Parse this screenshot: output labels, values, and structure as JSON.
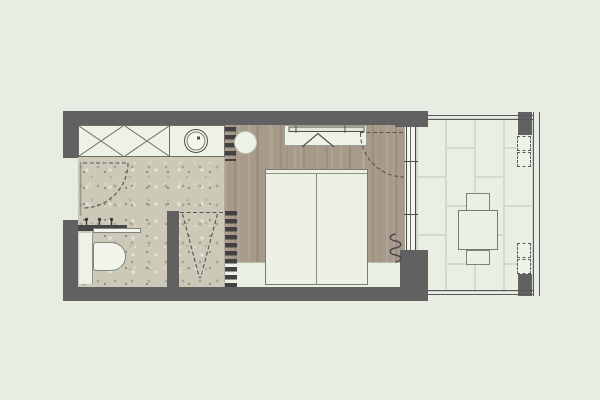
{
  "plan": {
    "kind": "studio-apartment-floor-plan",
    "rooms": [
      {
        "name": "bathroom",
        "fixtures": [
          "double-wardrobe-with-x-symbols",
          "counter-with-round-basin",
          "entry-door-swing",
          "towel-rail-with-hooks",
          "floating-shelf",
          "wall-hung-toilet",
          "walk-in-shower-with-drain-slope",
          "slatted-screen"
        ]
      },
      {
        "name": "bedroom",
        "fixtures": [
          "tv-console-with-wall-tv",
          "double-bed",
          "round-stool",
          "radiator-coil",
          "balcony-door-swing",
          "glazed-sliding-door"
        ]
      },
      {
        "name": "balcony",
        "fixtures": [
          "tile-floor-running-bond",
          "perimeter-railing",
          "corner-posts",
          "square-table",
          "two-chairs",
          "planter-boxes"
        ]
      }
    ]
  },
  "palette": {
    "background": "#e7ede2",
    "wall": "#616161",
    "bath_floor": "#cdc9b8",
    "wood_floor": "#a79a8a",
    "furniture_fill": "#eef2e6",
    "dash_line": "#55554d",
    "tile_fill": "#e9efe3",
    "tile_line": "#d4dbcc",
    "foot_strip": "#e9efe2"
  },
  "balcony_pattern": {
    "tile_w": 29,
    "tile_h": 58
  }
}
